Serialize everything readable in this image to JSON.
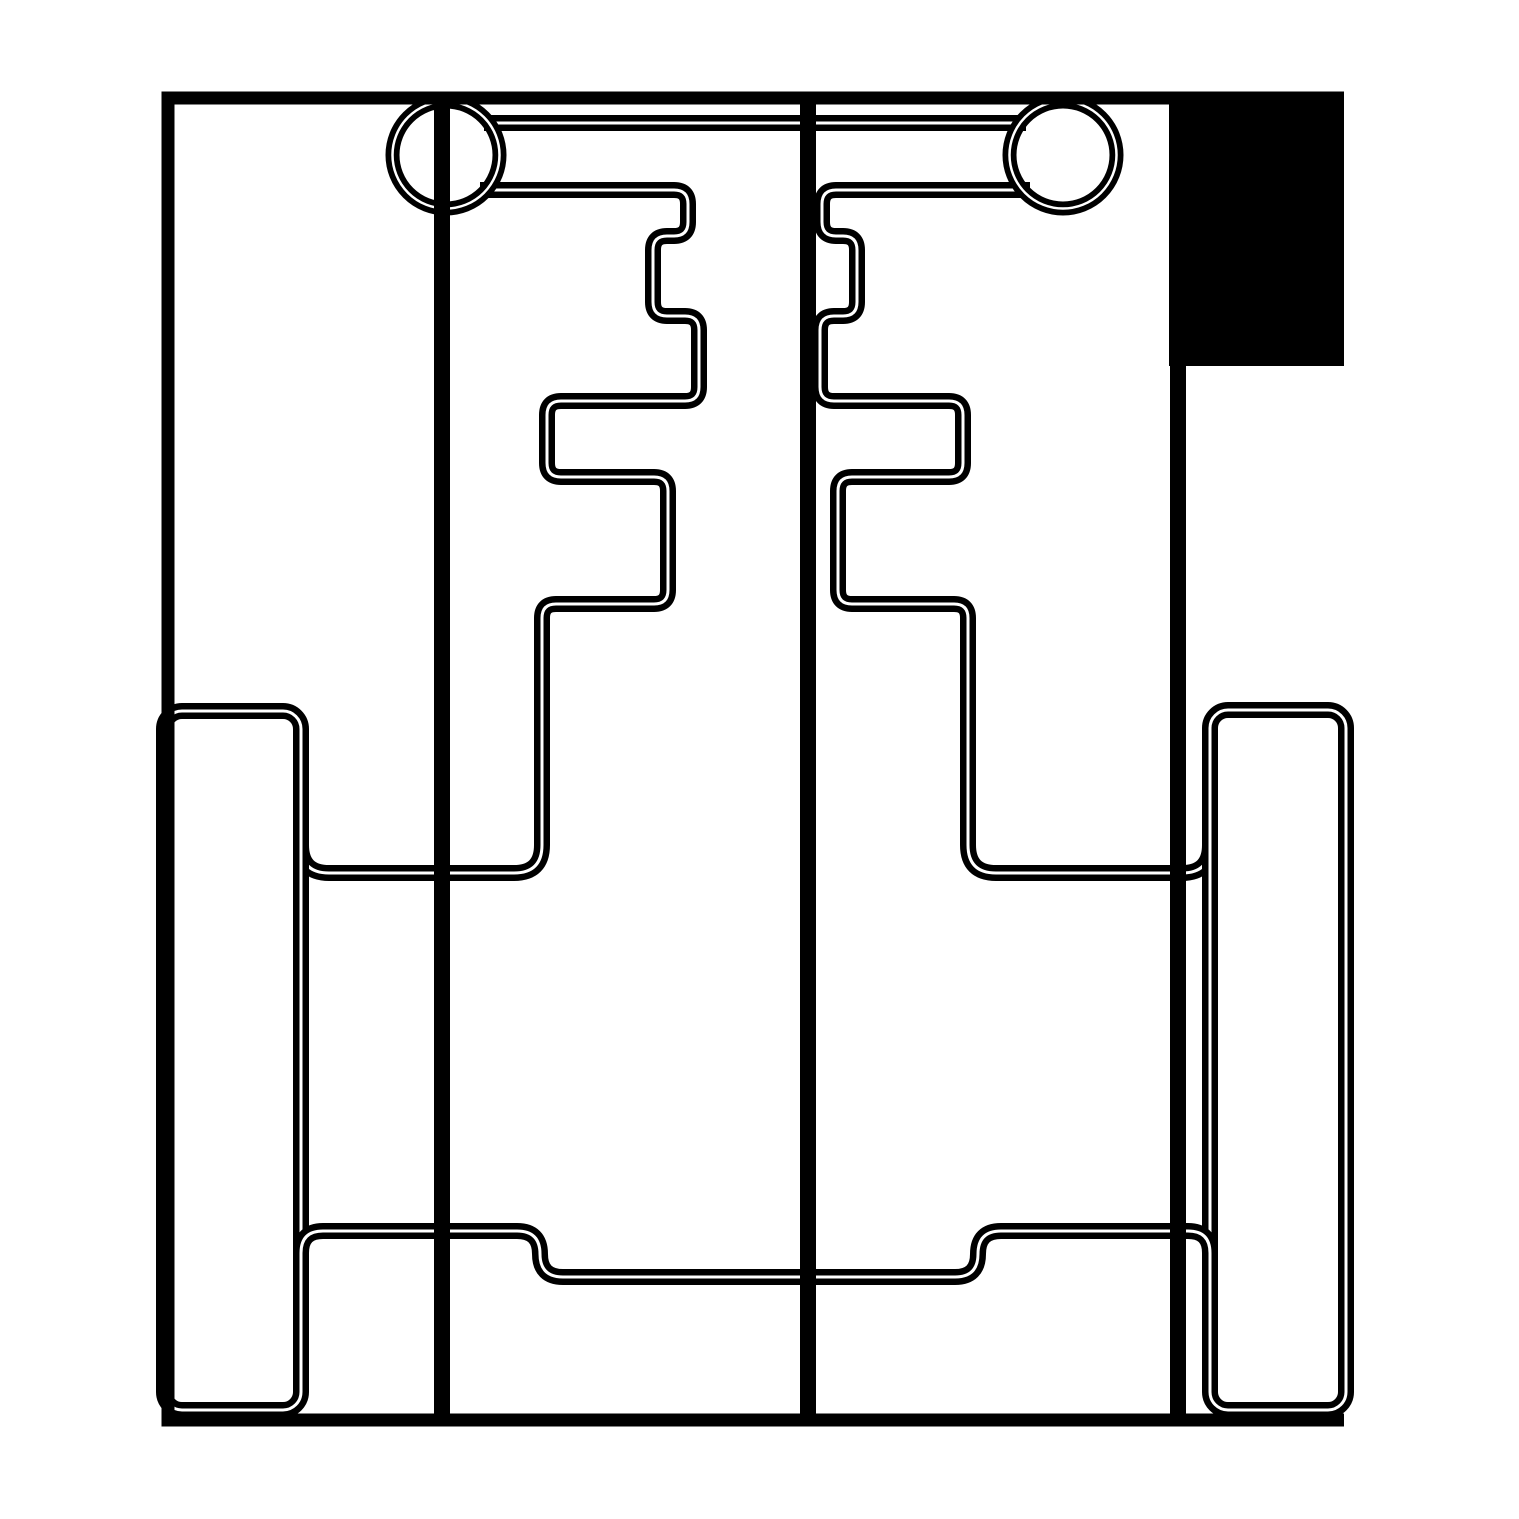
{
  "meta": {
    "kind": "technical-outline-drawing",
    "background": "#ffffff",
    "ink": "#000000",
    "canvas": {
      "width": 1519,
      "height": 1519
    }
  },
  "drawing": {
    "stroke_widths": {
      "outline": 13,
      "spine": 16,
      "double": 16,
      "double_core": 3,
      "ring": 14,
      "ring_core": 2.5
    },
    "shapes": [
      {
        "name": "flag-fill-rect",
        "kind": "fillrect",
        "x": 1169,
        "y": 92,
        "w": 175,
        "h": 274
      },
      {
        "name": "axle-crossbar",
        "kind": "path",
        "style": "double",
        "d": "M 484 123 H 1026"
      },
      {
        "name": "left-comb-profile",
        "kind": "path",
        "style": "double",
        "d": "M 480 190 L 674 190 Q 688 190 688 204 L 688 222 Q 688 236 674 236 L 667 236 Q 653 236 653 250 L 653 302 Q 653 316 667 316 L 685 316 Q 699 316 699 330 L 699 387 Q 699 401 685 401 L 561 401 Q 547 401 547 415 L 547 463 Q 547 477 561 477 L 654 477 Q 668 477 668 491 L 668 590 Q 668 604 654 604 L 556 604 Q 542 604 542 618 L 542 845 Q 542 873 514 873 L 329 873 Q 301 873 301 845"
      },
      {
        "name": "right-comb-profile",
        "kind": "path",
        "style": "double",
        "d": "M 1030 190 L 836 190 Q 822 190 822 204 L 822 222 Q 822 236 836 236 L 843 236 Q 857 236 857 250 L 857 302 Q 857 316 843 316 L 834 316 Q 820 316 820 330 L 820 387 Q 820 401 834 401 L 949 401 Q 963 401 963 415 L 963 463 Q 963 477 949 477 L 852 477 Q 838 477 838 491 L 838 590 Q 838 604 852 604 L 954 604 Q 968 604 968 618 L 968 845 Q 968 873 996 873 L 1182 873 Q 1210 873 1210 845"
      },
      {
        "name": "left-runner-outline",
        "kind": "rrect",
        "style": "double",
        "x": 164,
        "y": 711,
        "w": 137,
        "h": 699,
        "r": 18
      },
      {
        "name": "right-runner-outline",
        "kind": "rrect",
        "style": "double",
        "x": 1210,
        "y": 710,
        "w": 136,
        "h": 700,
        "r": 18
      },
      {
        "name": "bottom-step-line",
        "kind": "path",
        "style": "double",
        "d": "M 301 1253 Q 301 1231 323 1231 L 517 1231 Q 540 1231 540 1254 Q 540 1277 563 1277 L 955 1277 Q 978 1277 978 1254 Q 978 1231 1001 1231 L 1188 1231 Q 1210 1231 1210 1253"
      },
      {
        "name": "left-wheel-ring",
        "kind": "ring",
        "cx": 446,
        "cy": 155,
        "r": 53.5
      },
      {
        "name": "right-wheel-ring",
        "kind": "ring",
        "cx": 1063,
        "cy": 155,
        "r": 53.5
      },
      {
        "name": "frame-top-edge",
        "kind": "path",
        "style": "solid",
        "width": "outline",
        "d": "M 161.5 98 H 1344"
      },
      {
        "name": "frame-left-edge",
        "kind": "path",
        "style": "solid",
        "width": "outline",
        "d": "M 168 91.5 V 1426"
      },
      {
        "name": "frame-right-edge",
        "kind": "path",
        "style": "solid",
        "width": "spine",
        "d": "M 1178 91.5 V 1420"
      },
      {
        "name": "frame-bottom-edge",
        "kind": "path",
        "style": "solid",
        "width": "outline",
        "d": "M 161.5 1420 H 1344"
      },
      {
        "name": "left-axle-spine",
        "kind": "path",
        "style": "solid",
        "width": "spine",
        "d": "M 442 98 V 1419"
      },
      {
        "name": "center-spine",
        "kind": "path",
        "style": "solid",
        "width": "spine",
        "d": "M 808 98 V 1419"
      }
    ]
  }
}
